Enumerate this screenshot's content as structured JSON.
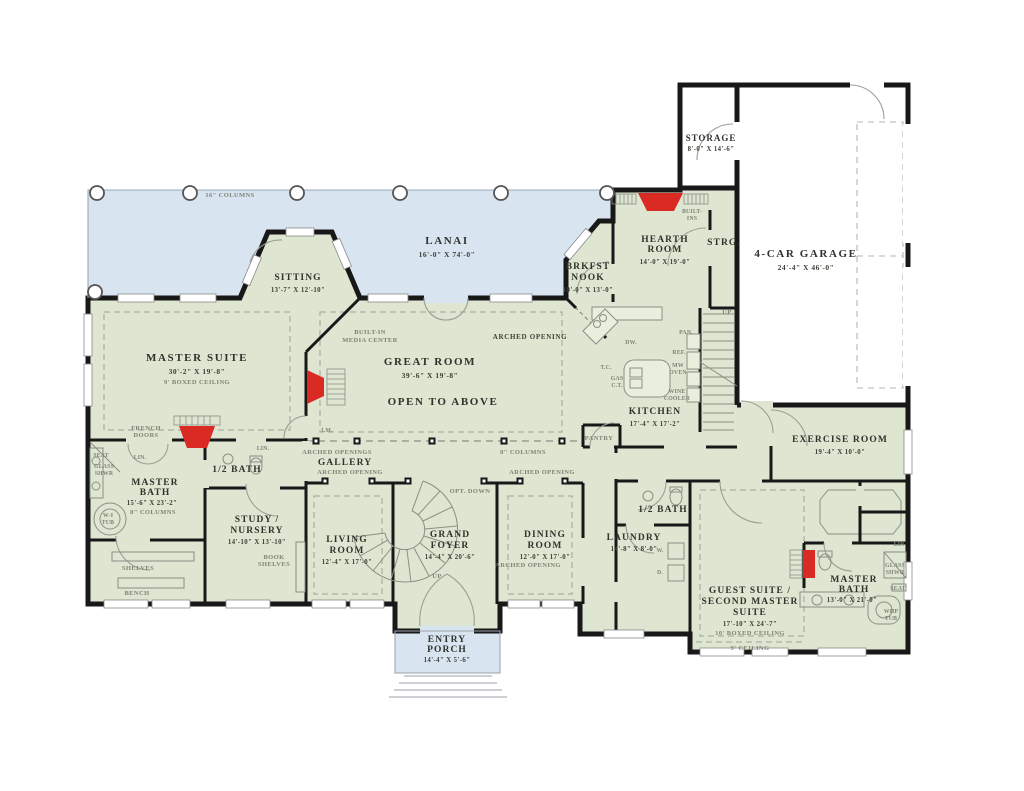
{
  "title": "First floor house plan",
  "colors": {
    "floor": "#dee5d0",
    "porch_lanai": "#d9e4f1",
    "wall": "#181818",
    "fireplace": "#d92b23",
    "garage_floor": "#ffffff",
    "detail_gray": "#8a9086"
  },
  "rooms": {
    "storage": {
      "lines": [
        "STORAGE"
      ],
      "dims": "8'-0\" X 14'-6\""
    },
    "garage": {
      "lines": [
        "4-CAR GARAGE"
      ],
      "dims": "24'-4\" X 46'-0\""
    },
    "strg": {
      "lines": [
        "STRG."
      ]
    },
    "hearth": {
      "lines": [
        "HEARTH",
        "ROOM"
      ],
      "dims": "14'-0\" X 19'-0\""
    },
    "lanai": {
      "lines": [
        "LANAI"
      ],
      "dims": "16'-0\" X 74'-0\""
    },
    "sitting": {
      "lines": [
        "SITTING"
      ],
      "dims": "13'-7\" X 12'-10\""
    },
    "brkfst": {
      "lines": [
        "BRKFST",
        "NOOK"
      ],
      "dims": "10'-0\" X 13'-0\""
    },
    "master_suite": {
      "lines": [
        "MASTER SUITE"
      ],
      "dims": "30'-2\" X 19'-8\"",
      "note": "9' BOXED CEILING"
    },
    "great_room": {
      "lines": [
        "GREAT ROOM"
      ],
      "dims": "39'-6\" X 19'-8\"",
      "note": "OPEN TO ABOVE"
    },
    "kitchen": {
      "lines": [
        "KITCHEN"
      ],
      "dims": "17'-4\" X 17'-2\""
    },
    "exercise": {
      "lines": [
        "EXERCISE ROOM"
      ],
      "dims": "19'-4\" X 10'-0\""
    },
    "master_bath_left": {
      "lines": [
        "MASTER",
        "BATH"
      ],
      "dims": "15'-6\" X 23'-2\""
    },
    "half_bath_left": {
      "lines": [
        "1/2 BATH"
      ]
    },
    "study": {
      "lines": [
        "STUDY /",
        "NURSERY"
      ],
      "dims": "14'-10\" X 13'-10\""
    },
    "living": {
      "lines": [
        "LIVING",
        "ROOM"
      ],
      "dims": "12'-4\" X 17'-0\""
    },
    "grand_foyer": {
      "lines": [
        "GRAND",
        "FOYER"
      ],
      "dims": "14'-4\" X 20'-6\""
    },
    "dining": {
      "lines": [
        "DINING",
        "ROOM"
      ],
      "dims": "12'-0\" X 17'-0\""
    },
    "gallery": {
      "lines": [
        "GALLERY"
      ]
    },
    "laundry": {
      "lines": [
        "LAUNDRY"
      ],
      "dims": "14'-8\" X 8'-0\""
    },
    "half_bath_right": {
      "lines": [
        "1/2 BATH"
      ]
    },
    "guest_suite": {
      "lines": [
        "GUEST SUITE /",
        "SECOND MASTER",
        "SUITE"
      ],
      "dims": "17'-10\" X 24'-7\"",
      "note": "10' BOXED CEILING"
    },
    "master_bath_right": {
      "lines": [
        "MASTER",
        "BATH"
      ],
      "dims": "13'-0\" X 21'-0\""
    },
    "entry_porch": {
      "lines": [
        "ENTRY",
        "PORCH"
      ],
      "dims": "14'-4\" X 5'-6\""
    }
  },
  "annotations": {
    "columns16": "16\" COLUMNS",
    "columns8": "8\" COLUMNS",
    "arched_opening": "ARCHED OPENING",
    "arched_openings": "ARCHED OPENINGS",
    "opt_down": "OPT. DOWN",
    "up": "UP",
    "french": [
      "FRENCH",
      "DOORS"
    ],
    "seat": "SEAT",
    "glass": [
      "GLASS",
      "SHWR"
    ],
    "lin": "LIN.",
    "wi_tub": [
      "W-I",
      "TUB"
    ],
    "shelves": "SHELVES",
    "bench": "BENCH",
    "book_shelves": [
      "BOOK",
      "SHELVES"
    ],
    "built_in_media": [
      "BUILT-IN",
      "MEDIA CENTER"
    ],
    "built_ins": [
      "BUILT-",
      "INS"
    ],
    "pan": "PAN.",
    "ref": "REF.",
    "mw_oven": [
      "MW",
      "OVEN"
    ],
    "wine_cooler": [
      "WINE",
      "COOLER"
    ],
    "gas_ct": [
      "GAS",
      "C.T."
    ],
    "tc": "T.C.",
    "dw": "DW.",
    "pantry": "PANTRY",
    "washer": "W.",
    "dryer": "D.",
    "whp_tub": [
      "WHP",
      "TUB"
    ],
    "ceiling9": "9' CEILING",
    "im": "I.M."
  }
}
